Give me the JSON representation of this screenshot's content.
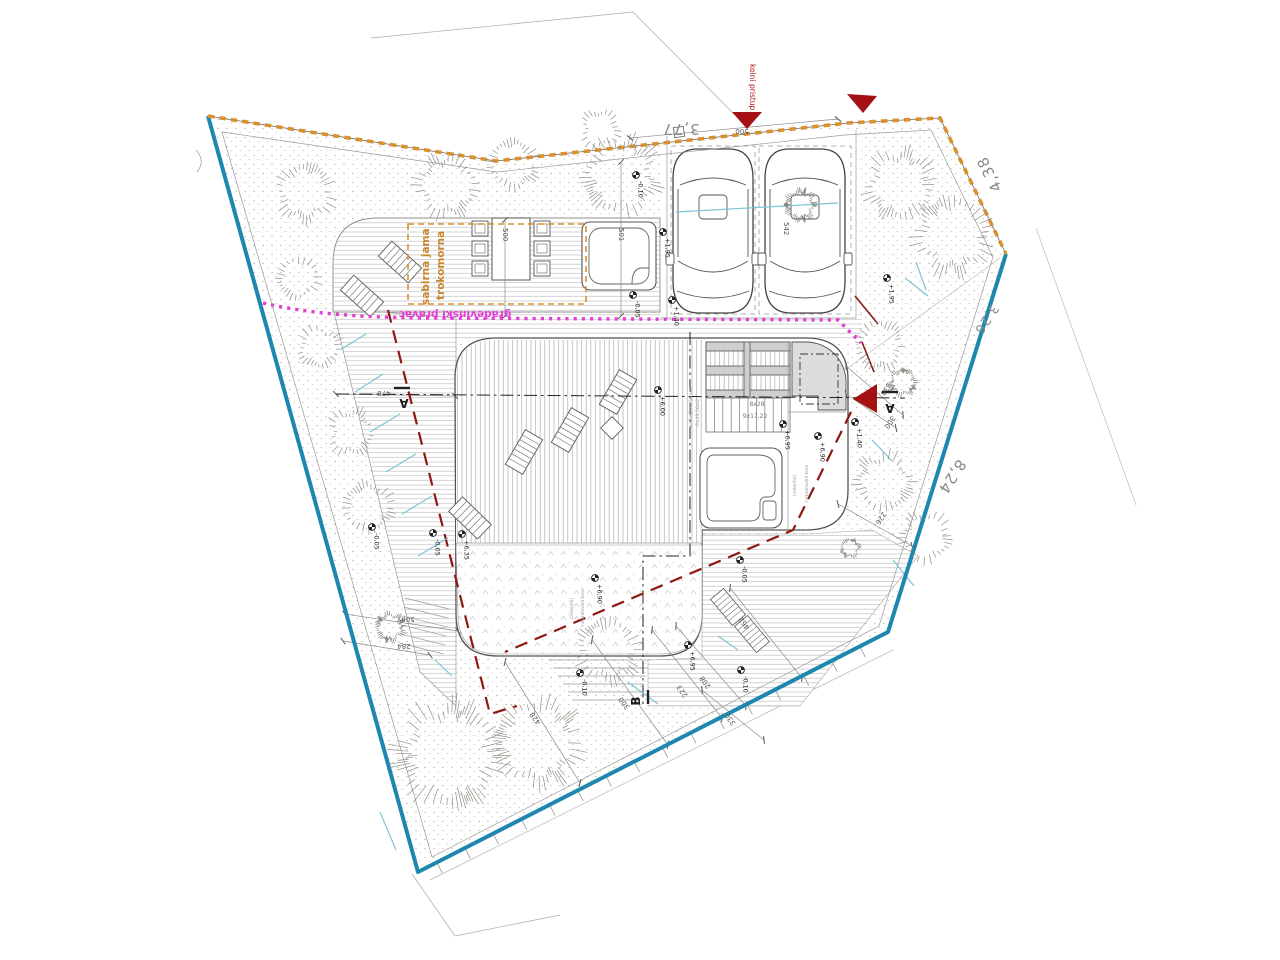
{
  "drawing": {
    "labels": {
      "access_road": "kolni pristup",
      "building_line": "građevinski pravac",
      "septic_line1": "trokomorna",
      "septic_line2": "sabirna jama",
      "green_roof_line1": "neprohodni krov",
      "green_roof_line2": "(zelenilo)",
      "terrace_line1": "ozelenjena terasa",
      "terrace_line2": "P=49,56m2",
      "stairs_line1": "8x28",
      "stairs_line2": "9x17,22",
      "section_a": "A",
      "section_b": "B"
    },
    "boundary_dims": {
      "top": "3,77",
      "top_right": "4,38",
      "right_upper": "3,26",
      "right_lower": "8,24"
    },
    "dims": {
      "d478": "478",
      "d500": "500",
      "d501": "501",
      "d542": "542",
      "d284": "284",
      "d333": "333",
      "d300": "300",
      "d226": "226",
      "d428": "428",
      "d223": "223",
      "d208": "208",
      "d462": "462",
      "d330": "330"
    },
    "elevations": {
      "e600": "+6,00",
      "e695": "+6,95",
      "e690": "+6,90",
      "e635": "+6,35",
      "m005": "-0,05",
      "m010": "-0,10",
      "e195": "+1,95",
      "e140": "+1,40"
    },
    "colors": {
      "boundary_blue": "#1d87b0",
      "boundary_orange": "#d9912f",
      "building_line_magenta": "#e23fd3",
      "setback_red": "#8f1812",
      "access_red": "#a31114",
      "annotation_gray": "#8a8a8a",
      "water_cyan": "#7cc5d6"
    }
  }
}
